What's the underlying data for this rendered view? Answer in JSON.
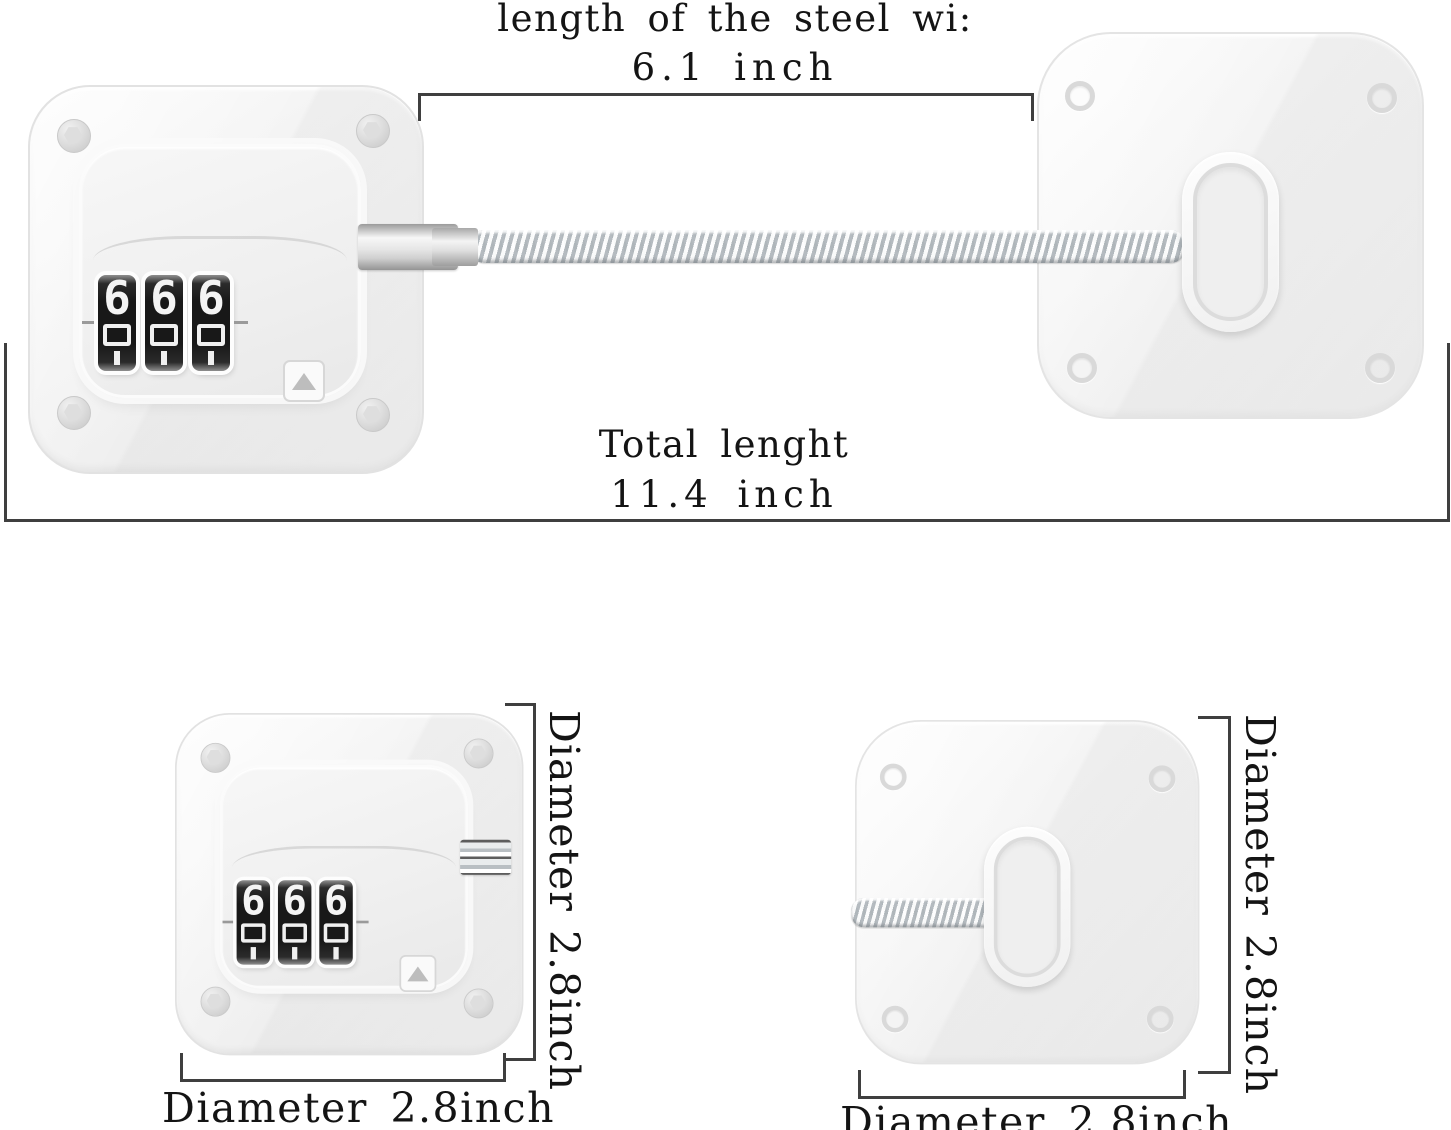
{
  "annotations": {
    "wire_length_label": "length of the steel wi:",
    "wire_length_value": "6.1 inch",
    "total_length_label": "Total lenght",
    "total_length_value": "11.4 inch",
    "lock_side_diameter": "Diameter 2.8inch",
    "lock_bottom_diameter": "Diameter 2.8inch",
    "pad_side_diameter": "Diameter 2.8inch",
    "pad_bottom_diameter": "Diameter 2.8inch"
  },
  "lock": {
    "dial_digits": [
      "6",
      "6",
      "6"
    ]
  },
  "colors": {
    "background": "#ffffff",
    "dimension_line": "#3f3f3f",
    "text": "#141414",
    "device_body": "#f3f3f3",
    "device_border": "#e2e2e2",
    "dial_background": "#181818",
    "dial_digit": "#f4f4f4",
    "cable": "#d7dcdf"
  }
}
